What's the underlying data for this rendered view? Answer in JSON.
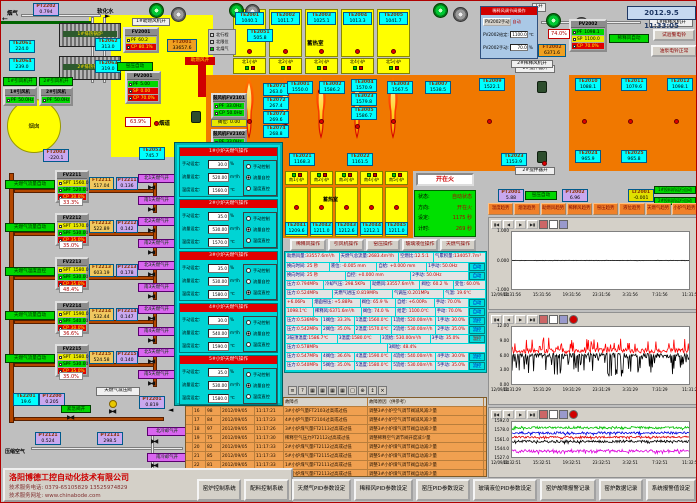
{
  "app": {
    "datetime": "2012.9.5 11:33:05"
  },
  "company": {
    "name": "洛阳博德工控自动化技术有限公司",
    "phone": "技术服务电话: 0379-65105829  13525974829",
    "web": "技术服务网址: www.chinabode.com"
  },
  "labels": {
    "yanqi": "烟气",
    "ruanhua": "软化水",
    "yancong": "烟囱",
    "yandao": "烟道",
    "fan1on": "1#引风机开",
    "fan2on": "2#引风机开",
    "zhuran_on": "助燃风开",
    "zhuranji": "1#助燃风机开",
    "yayun": "窑压自动",
    "yayun2": "窑压自动",
    "xishi_auto": "稀释风自动",
    "xsfj1": "1#稀释风机开",
    "xsfj2": "2#稀释风机开",
    "jbq1": "1#搅拌器开",
    "jbq2": "2#搅拌器开",
    "xureshi": "蓄热室",
    "xureshi2": "蓄热室",
    "ex1": "1#排热锅炉",
    "ex2": "2#排热锅炉",
    "jinji": "紧急阀开",
    "jianya": "天燃气减压阀",
    "yasuo": "压缩空气",
    "cooln": "北冷却气开",
    "cools": "南冷却气开",
    "tl1": "1#投料机运行自动",
    "tl2": "2#投料机运行自动",
    "btn_bell": "试验警电铃",
    "btn_pump": "油泵电铃正常",
    "fawei": "阀位: 0.00",
    "pct639": "63.9%",
    "pct740": "74.0%",
    "k1": "1开",
    "legend": [
      "北行程",
      "北限位",
      "北煤气"
    ],
    "north_ports": [
      "北1小炉",
      "北2小炉",
      "北3小炉",
      "北4小炉",
      "北5小炉"
    ],
    "south_ports": [
      "南1小炉",
      "南2小炉",
      "南3小炉",
      "南4小炉",
      "南5小炉"
    ]
  },
  "sensors": {
    "PT2202": "0.794",
    "TE2061": "224.0",
    "TE2064": "239.0",
    "TE2062": "313.0",
    "TE2063": "319.0",
    "FT2003": "-220.1",
    "TE2053": "745.7",
    "FT2001": "33657.6",
    "TE2051": "505.8",
    "TE2001": "1040.1",
    "TE2002": "1011.7",
    "TE2003": "1025.1",
    "TE2004": "1013.3",
    "TE2005": "1041.7",
    "TE2071": "263.0",
    "TE2072": "267.4",
    "TE2073": "269.6",
    "TE2074": "268.8",
    "TE3001": "1550.0",
    "TE3002": "1586.2",
    "TE3004": "1570.9",
    "TE3023": "1579.8",
    "TE3005": "1586.7",
    "TE3003": "1567.5",
    "TE3007": "1538.5",
    "TE2021": "1168.3",
    "TE2022": "1161.5",
    "TE2023": "1153.9",
    "TE2024": "965.9",
    "TE2025": "965.8",
    "TE2009": "1522.1",
    "TE2010": "1088.1",
    "TE2011": "1079.6",
    "TE2012": "1098.1",
    "TE2041": "1209.6",
    "TE2042": "1211.0",
    "TE2043": "1212.6",
    "TE2044": "1212.1",
    "TE2045": "1211.0",
    "PT2001": "5.88",
    "PT2002": "6.96",
    "LT2001": "-0.001",
    "FT2002": "6371.6",
    "TE2201": "19.6",
    "PT2200": "0.205",
    "PT2201": "0.819",
    "PT2121": "0.524",
    "PT2131": "298.5",
    "FT2211": "517.04",
    "FT2212": "522.89",
    "FT2213": "603.19",
    "FT2214": "532.44",
    "FT2215": "524.58",
    "PT2211": "0.136",
    "PT2212": "0.142",
    "PT2213": "0.178",
    "PT2214": "0.147",
    "PT2215": "0.140"
  },
  "controllers": {
    "FV2001": {
      "t": "FV2001",
      "rows": [
        [
          "PF",
          "60.2",
          "y"
        ],
        [
          "CP",
          "80.1%",
          "r"
        ]
      ]
    },
    "PV2001": {
      "t": "PV2001",
      "rows": [
        [
          "PF",
          "5.00",
          "g"
        ],
        [
          "SP",
          "0.00",
          "r"
        ],
        [
          "CP",
          "70.0%",
          "r"
        ]
      ]
    },
    "PV2002": {
      "t": "PV2002",
      "rows": [
        [
          "PF",
          "1098.1",
          "g"
        ],
        [
          "SP",
          "1100.0",
          "y"
        ],
        [
          "CP",
          "70.0%",
          "r"
        ]
      ]
    },
    "YF1": {
      "t": "1#引风机",
      "rows": [
        [
          "PF",
          "50.0Hz",
          "g"
        ]
      ]
    },
    "YF2": {
      "t": "2#引风机",
      "rows": [
        [
          "PF",
          "50.0Hz",
          "g"
        ]
      ]
    },
    "GF1": {
      "t": "鼓风机FV2101",
      "rows": [
        [
          "PF",
          "33.0Hz",
          "g"
        ],
        [
          "CP",
          "50.0Hz",
          "g"
        ]
      ]
    },
    "GF2": {
      "t": "鼓风机FV2102",
      "rows": [
        [
          "PF",
          "33.0Hz",
          "g"
        ],
        [
          "CP",
          "50.0Hz",
          "g"
        ]
      ]
    },
    "FV2211": {
      "t": "FV2211",
      "rows": [
        [
          "SPT",
          "1560.0",
          "y"
        ],
        [
          "SPF",
          "520.00",
          "g"
        ],
        [
          "CP",
          "30.0%",
          "r"
        ]
      ]
    },
    "FV2212": {
      "t": "FV2212",
      "rows": [
        [
          "SPT",
          "1570.0",
          "y"
        ],
        [
          "SPF",
          "530.00",
          "g"
        ],
        [
          "CP",
          "35.0%",
          "r"
        ]
      ]
    },
    "FV2213": {
      "t": "FV2213",
      "rows": [
        [
          "SPT",
          "1580.0",
          "y"
        ],
        [
          "SPF",
          "530.00",
          "g"
        ],
        [
          "CP",
          "35.0%",
          "r"
        ]
      ]
    },
    "FV2214": {
      "t": "FV2214",
      "rows": [
        [
          "SPT",
          "1590.0",
          "y"
        ],
        [
          "SPF",
          "540.00",
          "g"
        ],
        [
          "CP",
          "30.0%",
          "r"
        ]
      ]
    },
    "FV2215": {
      "t": "FV2215",
      "rows": [
        [
          "SPT",
          "1580.0",
          "y"
        ],
        [
          "SPF",
          "530.00",
          "g"
        ],
        [
          "CP",
          "35.0%",
          "r"
        ]
      ]
    }
  },
  "gas_rows": [
    {
      "auto": "天燃气流量自动",
      "fv": "FV2211",
      "out": "33.3%",
      "ft": "FT2211",
      "pt": "PT2211",
      "vn": "北1天燃气开",
      "vs": "南1天燃气开"
    },
    {
      "auto": "天燃气流量自动",
      "fv": "FV2212",
      "out": "35.0%",
      "ft": "FT2212",
      "pt": "PT2212",
      "vn": "北2天燃气开",
      "vs": "南2天燃气开"
    },
    {
      "auto": "天燃气温度直控",
      "fv": "FV2213",
      "out": "48.4%",
      "ft": "FT2213",
      "pt": "PT2213",
      "vn": "北3天燃气开",
      "vs": "南3天燃气开"
    },
    {
      "auto": "天燃气流量自动",
      "fv": "FV2214",
      "out": "36.6%",
      "ft": "FT2214",
      "pt": "PT2214",
      "vn": "北4天燃气开",
      "vs": "南4天燃气开"
    },
    {
      "auto": "天燃气流量自动",
      "fv": "FV2215",
      "out": "35.0%",
      "ft": "FT2215",
      "pt": "PT2215",
      "vn": "北5天燃气开",
      "vs": "南5天燃气开"
    }
  ],
  "dialog": {
    "title": "稀释风调节阀操作",
    "btn": "PV2002手动",
    "mode": "自动",
    "rows": [
      [
        "PV2002给定:",
        "1100.0",
        "℃"
      ],
      [
        "PV2002手动:",
        "70.0",
        "%"
      ]
    ]
  },
  "popup": {
    "field_labels": [
      "手动设定:",
      "流量设定:",
      "温度设定:"
    ],
    "units": [
      "%",
      "m³/h",
      "℃"
    ],
    "radio_labels": [
      "手动控制",
      "流量自控",
      "温度直控"
    ],
    "sections": [
      {
        "title": "1#小炉天燃气操作",
        "manual": "30.0",
        "flow": "520.00",
        "temp": "1560.0",
        "mode": 1
      },
      {
        "title": "2#小炉天燃气操作",
        "manual": "35.0",
        "flow": "530.00",
        "temp": "1570.0",
        "mode": 1
      },
      {
        "title": "3#小炉天燃气操作",
        "manual": "35.0",
        "flow": "530.00",
        "temp": "1580.0",
        "mode": 2
      },
      {
        "title": "4#小炉天燃气操作",
        "manual": "30.0",
        "flow": "540.00",
        "temp": "1590.0",
        "mode": 1
      },
      {
        "title": "5#小炉天燃气操作",
        "manual": "35.0",
        "flow": "530.00",
        "temp": "1580.0",
        "mode": 1
      }
    ]
  },
  "status": {
    "button": "开在火",
    "rows": [
      [
        "状态:",
        "自动状态"
      ],
      [
        "方向:",
        "开在火"
      ],
      [
        "设定:",
        "1175 秒"
      ],
      [
        "计时:",
        "269 秒"
      ]
    ]
  },
  "op_buttons": [
    "稀释风操作",
    "引风机操作",
    "窑压操作",
    "玻璃液位操作",
    "天燃气操作"
  ],
  "summary": [
    [
      "助燃风量:",
      "33557.6m³/h"
    ],
    [
      "天燃气总流量:",
      "2683.4m³/h"
    ],
    [
      "空燃比:",
      "12.5:1"
    ],
    [
      "气累积量:",
      "134057.7m³"
    ]
  ],
  "data_rows": [
    [
      "换向时间: 25 秒",
      "液位: -0.005 mm",
      "自给: +0.000 mm",
      "1手动: 50.0Hz",
      "自动"
    ],
    [
      "换向时间: 25 秒",
      "自控: +0.000 mm",
      "2手动: 50.0Hz",
      "自动"
    ],
    [
      "压力:0.794MPa",
      "冷却气压: 298.5KPa",
      "助燃风:33557.6m³/h",
      "阀位: 60.2 %",
      "变位: 60.0%"
    ],
    [
      "压力:0.524MPa",
      "天燃气进压:0.819MPa",
      "气调压:0.201MPa",
      "气温: 19.6℃"
    ],
    [
      "+6.06Pa",
      "烟囱窑压: +5.88Pa",
      "阀位: 65.9 %",
      "自给: +6.00Pa",
      "手动: 70.0%",
      "自动"
    ],
    [
      "1098.1℃",
      "稀释风:6371.6m³/h",
      "阀位: 74.0 %",
      "给定: 1100.0℃",
      "手动: 70.0%",
      "自动"
    ],
    [
      "压力:0.536MPa",
      "1阀位: 33.3%",
      "1温度:1560.0℃",
      "1流给: 520.00m³/h",
      "1手动: 30.0%",
      "流控"
    ],
    [
      "压力:0.542MPa",
      "2阀位: 35.0%",
      "2温度:1570.0℃",
      "2流给: 530.00m³/h",
      "2手动: 35.0%",
      "流控"
    ],
    [
      "3碹顶温度:1586.7℃",
      "3温度:1580.0℃",
      "3流给: 530.00m³/h",
      "3手动: 35.0%",
      "温控"
    ],
    [
      "压力:0.578MPa",
      "3阀位: 48.4%"
    ],
    [
      "压力:0.547MPa",
      "4阀位: 36.6%",
      "4温度:1590.0℃",
      "4流给: 540.00m³/h",
      "4手动: 30.0%",
      "流控"
    ],
    [
      "压力:0.540MPa",
      "5阀位: 35.0%",
      "5温度:1580.0℃",
      "5流给: 530.00m³/h",
      "5手动: 35.0%",
      "流控"
    ]
  ],
  "table_toolbar": [
    "≡",
    "?",
    "▦",
    "▦",
    "▦",
    "▦",
    "□",
    "⊕",
    "↕",
    "×"
  ],
  "alarm": {
    "headers": [
      "故障点",
      "故障原因（供参考）"
    ],
    "rows": [
      [
        "16",
        "98",
        "2012/09/05",
        "11:17:21",
        "3#小炉气量FT2103过高或过低",
        "调整3#小炉空气调节阀减风减少量"
      ],
      [
        "17",
        "84",
        "2012/09/05",
        "11:17:23",
        "4#小炉气量FT2104过高或过低",
        "调整4#小炉空气调节阀减风减少量"
      ],
      [
        "18",
        "97",
        "2012/09/05",
        "11:17:26",
        "3#小炉煤气量FT2113过高或过低",
        "调整3#小炉煤气调节阀自动减少量"
      ],
      [
        "19",
        "75",
        "2012/09/05",
        "11:17:30",
        "稀释空气压力PT2112过高或过低",
        "调整稀释空气调节阀开度减少量"
      ],
      [
        "20",
        "82",
        "2012/09/05",
        "11:17:33",
        "2#小炉煤气量FT2112过高或过低",
        "调整2#小炉煤气调节阀自动减少量"
      ],
      [
        "21",
        "85",
        "2012/09/05",
        "11:17:33",
        "5#小炉煤气量FT2115过高或过低",
        "调整5#小炉煤气调节阀自动减少量"
      ],
      [
        "22",
        "81",
        "2012/09/05",
        "11:17:33",
        "1#小炉煤气量FT2111过高或过低",
        "调整1#小炉煤气调节阀自动减少量"
      ],
      [
        "23",
        "83",
        "2012/09/05",
        "11:17:33",
        "3#小炉煤气量FT2113过高或过低",
        "调整3#小炉煤气调节阀自动减少量"
      ]
    ]
  },
  "trend_buttons": [
    "温度趋势",
    "烟温趋势",
    "助燃风趋势",
    "稀释风趋势",
    "窑压趋势",
    "液位趋势",
    "天燃气趋势",
    "小炉气趋势"
  ],
  "chart_data": [
    {
      "type": "line",
      "title": "玻璃液位趋势",
      "date": "12/09/04",
      "x_ticks": [
        "11:31:56",
        "15:31:56",
        "19:31:56",
        "23:31:56",
        "3:31:56",
        "7:31:56",
        "11:31:56"
      ],
      "y_ticks": [
        "1.000",
        "0.000",
        "-1.000"
      ],
      "ylim": [
        -1.25,
        1.25
      ],
      "series": [
        {
          "name": "玻璃液位",
          "color": "#000000",
          "base": 0.0,
          "noise": 0.01,
          "spike_prob": 0,
          "spike": 0
        }
      ]
    },
    {
      "type": "line",
      "title": "窑压趋势",
      "date": "12/09/04",
      "x_ticks": [
        "11:31:29",
        "15:31:29",
        "19:31:29",
        "23:31:29",
        "3:31:29",
        "7:31:29",
        "11:31:29"
      ],
      "y_ticks": [
        "12.00",
        "9.00",
        "6.00",
        "3.00",
        "0.00"
      ],
      "ylim": [
        0,
        12
      ],
      "series": [
        {
          "name": "窑压给定",
          "color": "#ff0000",
          "base": 7.0,
          "noise": 0.5,
          "spike_prob": 0.2,
          "spike": 3.0
        },
        {
          "name": "窑压实测",
          "color": "#000000",
          "base": 6.0,
          "noise": 0.5,
          "spike_prob": 0.3,
          "spike": -4.5
        }
      ]
    },
    {
      "type": "line",
      "title": "小炉温度趋势",
      "date": "12/09/04",
      "x_ticks": [
        "11:32:51",
        "15:32:51",
        "19:32:51",
        "23:32:51",
        "3:32:51",
        "7:32:51",
        "11:32:51"
      ],
      "y_ticks": [
        "1592.0",
        "1578.0",
        "1561.0",
        "1544.0",
        "1527.0"
      ],
      "ylim": [
        1523,
        1597
      ],
      "series": [
        {
          "name": "1#小炉",
          "color": "#00c000",
          "base": 1585,
          "noise": 2.5,
          "spike_prob": 0.12,
          "spike": -5
        },
        {
          "name": "2#小炉",
          "color": "#0000dd",
          "base": 1574,
          "noise": 2.5,
          "spike_prob": 0.12,
          "spike": -5
        },
        {
          "name": "3#小炉",
          "color": "#dd0000",
          "base": 1565,
          "noise": 2.0,
          "spike_prob": 0.1,
          "spike": -4
        },
        {
          "name": "4#小炉",
          "color": "#000000",
          "base": 1556,
          "noise": 2.5,
          "spike_prob": 0.12,
          "spike": -5
        },
        {
          "name": "5#小炉",
          "color": "#dd00dd",
          "base": 1536,
          "noise": 3.0,
          "spike_prob": 0.15,
          "spike": -6
        }
      ]
    }
  ],
  "bottom_buttons": [
    "窑炉控制系统",
    "配料控制系统",
    "天燃气PID参数设定",
    "稀释风PID参数设定",
    "窑压PID参数设定",
    "玻璃液位PID参数设定",
    "窑炉故障报警记录",
    "窑炉数据记录",
    "系统报警值设定"
  ]
}
